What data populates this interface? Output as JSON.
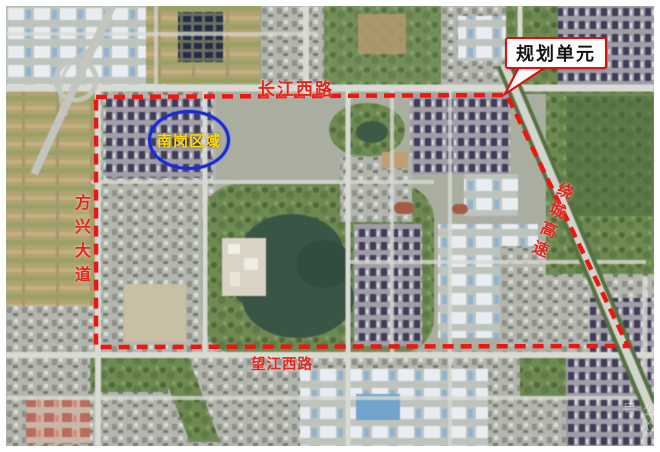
{
  "map": {
    "callout": {
      "label": "规划单元"
    },
    "zone_oval": {
      "label": "南岗区域"
    },
    "road_labels": {
      "top": "长江西路",
      "bottom": "望江西路",
      "left": "方兴大道",
      "right": "绕城高速"
    },
    "watermark": "公众号",
    "colors": {
      "boundary_red": "#ee1610",
      "callout_border": "#e01010",
      "road_label_red": "#e3251b",
      "zone_ellipse_blue": "#1a2ad6",
      "zone_text_yellow": "#ffd900",
      "lake_green": "#385546"
    }
  }
}
